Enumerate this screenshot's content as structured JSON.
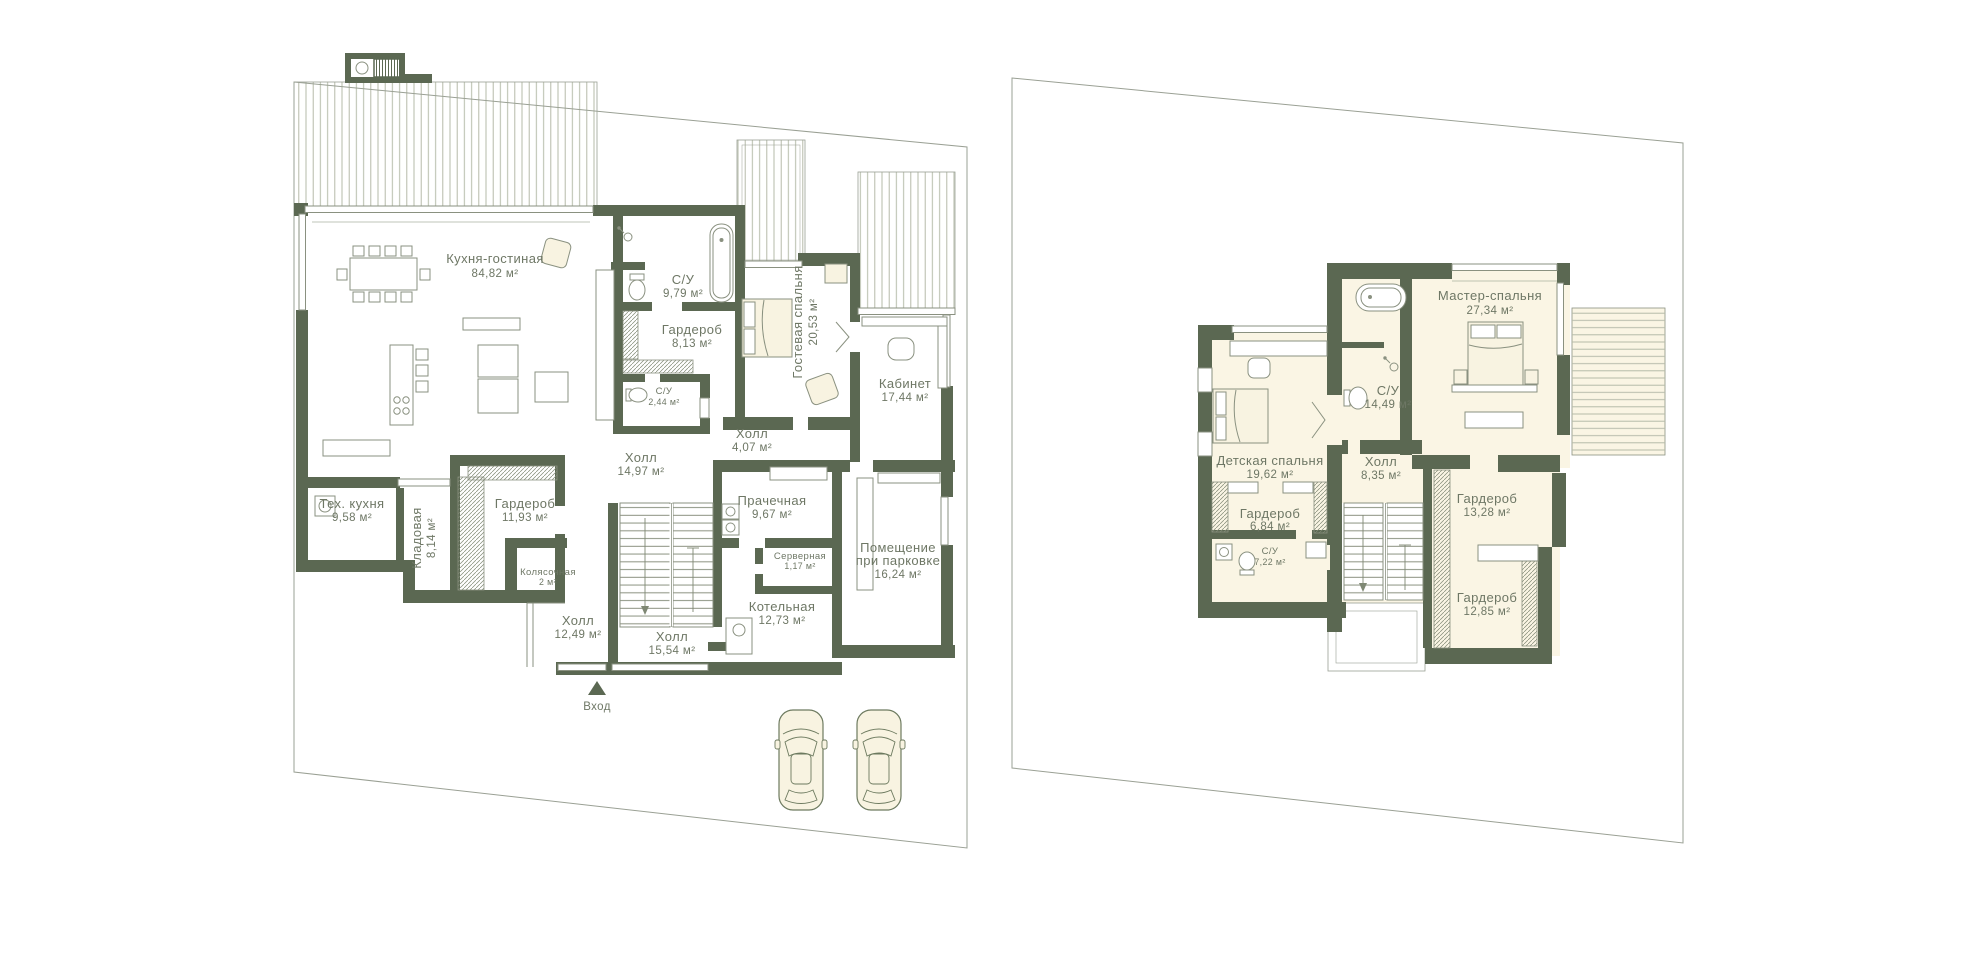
{
  "colors": {
    "wall": "#5b6852",
    "thin_line": "#8a9180",
    "hatch_line": "#b5bba9",
    "lot_line": "#9aa094",
    "room_fill": "#faf5e4",
    "furniture_fill": "#f8f3e1",
    "label_text": "#6e7765"
  },
  "floor1": {
    "entrance_label": "Вход",
    "rooms": [
      {
        "name": "Кухня-гостиная",
        "area": "84,82 м²"
      },
      {
        "name": "С/У",
        "area": "9,79 м²"
      },
      {
        "name": "Гардероб",
        "area": "8,13 м²"
      },
      {
        "name": "С/У",
        "area": "2,44 м²"
      },
      {
        "name": "Гостевая спальня",
        "area": "20,53 м²"
      },
      {
        "name": "Кабинет",
        "area": "17,44 м²"
      },
      {
        "name": "Холл",
        "area": "4,07 м²"
      },
      {
        "name": "Холл",
        "area": "14,97 м²"
      },
      {
        "name": "Тех. кухня",
        "area": "9,58 м²"
      },
      {
        "name": "Кладовая",
        "area": "8,14 м²"
      },
      {
        "name": "Гардероб",
        "area": "11,93 м²"
      },
      {
        "name": "Колясочная",
        "area": "2 м²"
      },
      {
        "name": "Холл",
        "area": "12,49 м²"
      },
      {
        "name": "Холл",
        "area": "15,54 м²"
      },
      {
        "name": "Прачечная",
        "area": "9,67 м²"
      },
      {
        "name": "Серверная",
        "area": "1,17 м²"
      },
      {
        "name": "Котельная",
        "area": "12,73 м²"
      },
      {
        "name_line1": "Помещение",
        "name_line2": "при парковке",
        "area": "16,24 м²"
      }
    ]
  },
  "floor2": {
    "rooms": [
      {
        "name": "Мастер-спальня",
        "area": "27,34 м²"
      },
      {
        "name": "С/У",
        "area": "14,49 м²"
      },
      {
        "name": "Холл",
        "area": "8,35 м²"
      },
      {
        "name": "Детская спальня",
        "area": "19,62 м²"
      },
      {
        "name": "Гардероб",
        "area": "6,84 м²"
      },
      {
        "name": "С/У",
        "area": "7,22 м²"
      },
      {
        "name": "Гардероб",
        "area": "13,28 м²"
      },
      {
        "name": "Гардероб",
        "area": "12,85 м²"
      }
    ]
  }
}
